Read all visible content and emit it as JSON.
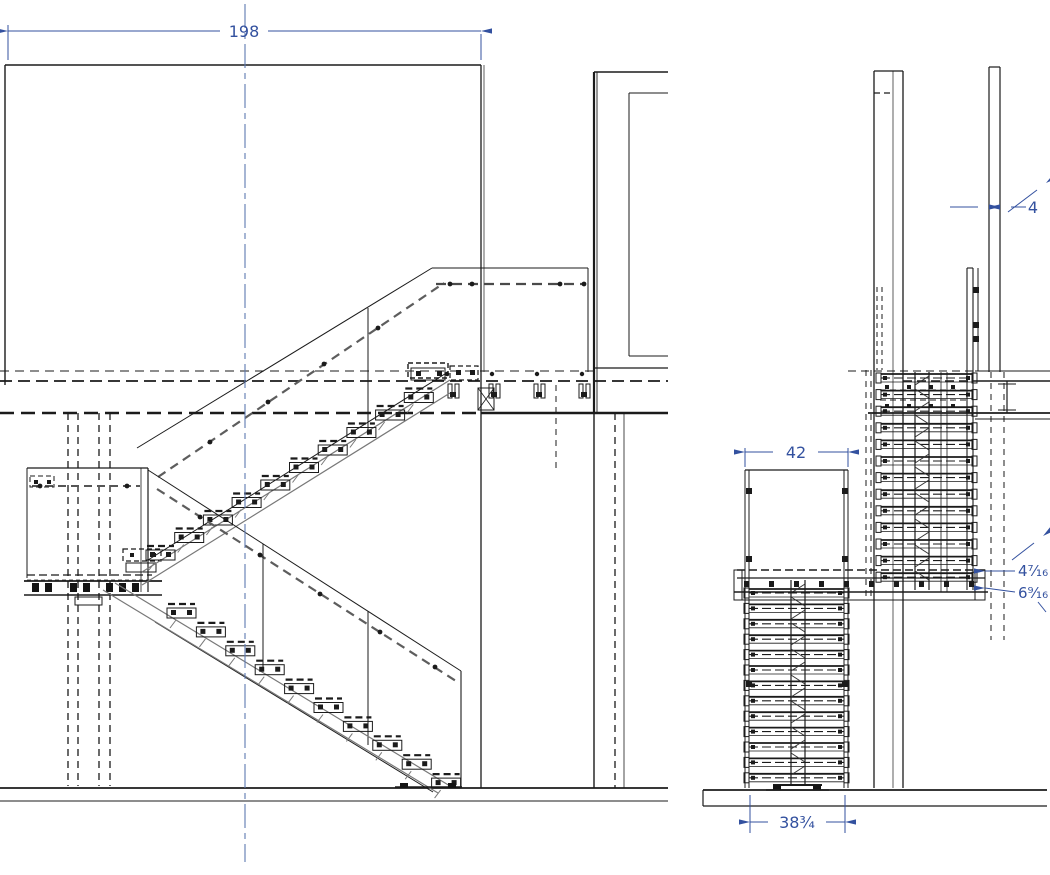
{
  "drawing": {
    "type": "stair-shop-drawing",
    "views": [
      {
        "id": "elevation",
        "name": "front-elevation"
      },
      {
        "id": "section",
        "name": "side-section"
      }
    ]
  },
  "colors": {
    "dimension": "#33519f",
    "centerline": "#5e79b0",
    "line": "#1b1b1b",
    "gray": "#787878"
  },
  "dimensions": {
    "overall_width": {
      "label": "198"
    },
    "glass_thickness": {
      "label": "4"
    },
    "stair_width": {
      "label": "42"
    },
    "offset_upper": {
      "label": "4⁷⁄₁₆"
    },
    "offset_lower": {
      "label": "6⁹⁄₁₆"
    },
    "base_width": {
      "label": "38¾"
    }
  }
}
